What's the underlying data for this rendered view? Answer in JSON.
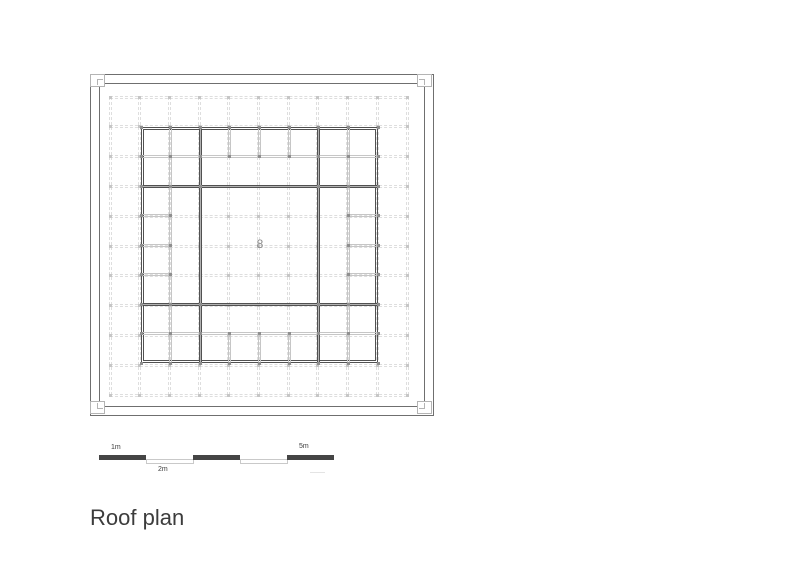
{
  "plan": {
    "center_label": "8"
  },
  "scale_bar": {
    "label_1m": "1m",
    "label_2m": "2m",
    "label_5m": "5m"
  },
  "title": "Roof plan",
  "colors": {
    "frame_line": "#6f6f6f",
    "structure_dark": "#515151",
    "structure_light": "#c6c6c6",
    "grid_dash": "#dedede",
    "scale_dark": "#454545",
    "text_dark": "#3c3c3c",
    "label_gray": "#8a8a8a"
  }
}
